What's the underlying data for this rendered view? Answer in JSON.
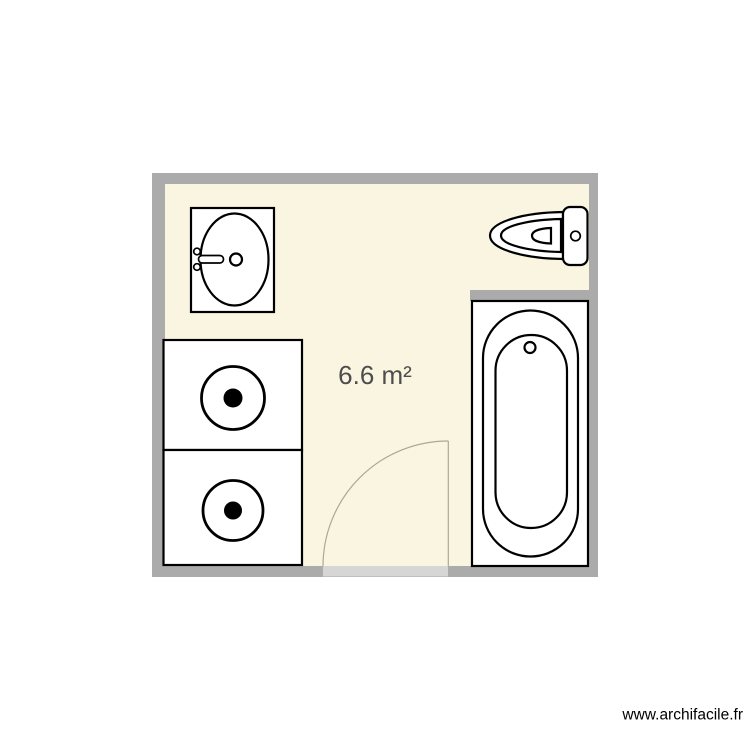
{
  "plan": {
    "area_label": "6.6 m²",
    "watermark": "www.archifacile.fr",
    "room_name": "bathroom-floor-plan",
    "fixtures": [
      {
        "name": "sink"
      },
      {
        "name": "toilet"
      },
      {
        "name": "bathtub"
      },
      {
        "name": "washing-machine-top"
      },
      {
        "name": "washing-machine-bottom"
      },
      {
        "name": "door"
      }
    ]
  },
  "colors": {
    "page_background": "#ffffff",
    "wall": "#ababab",
    "floor": "#faf5e0",
    "door_opening": "#d6d6d6",
    "door_arc": "#ada795",
    "fixture_fill": "#ffffff",
    "fixture_stroke": "#000000",
    "area_label_text": "#4d4d4d",
    "watermark_text": "#000000"
  }
}
